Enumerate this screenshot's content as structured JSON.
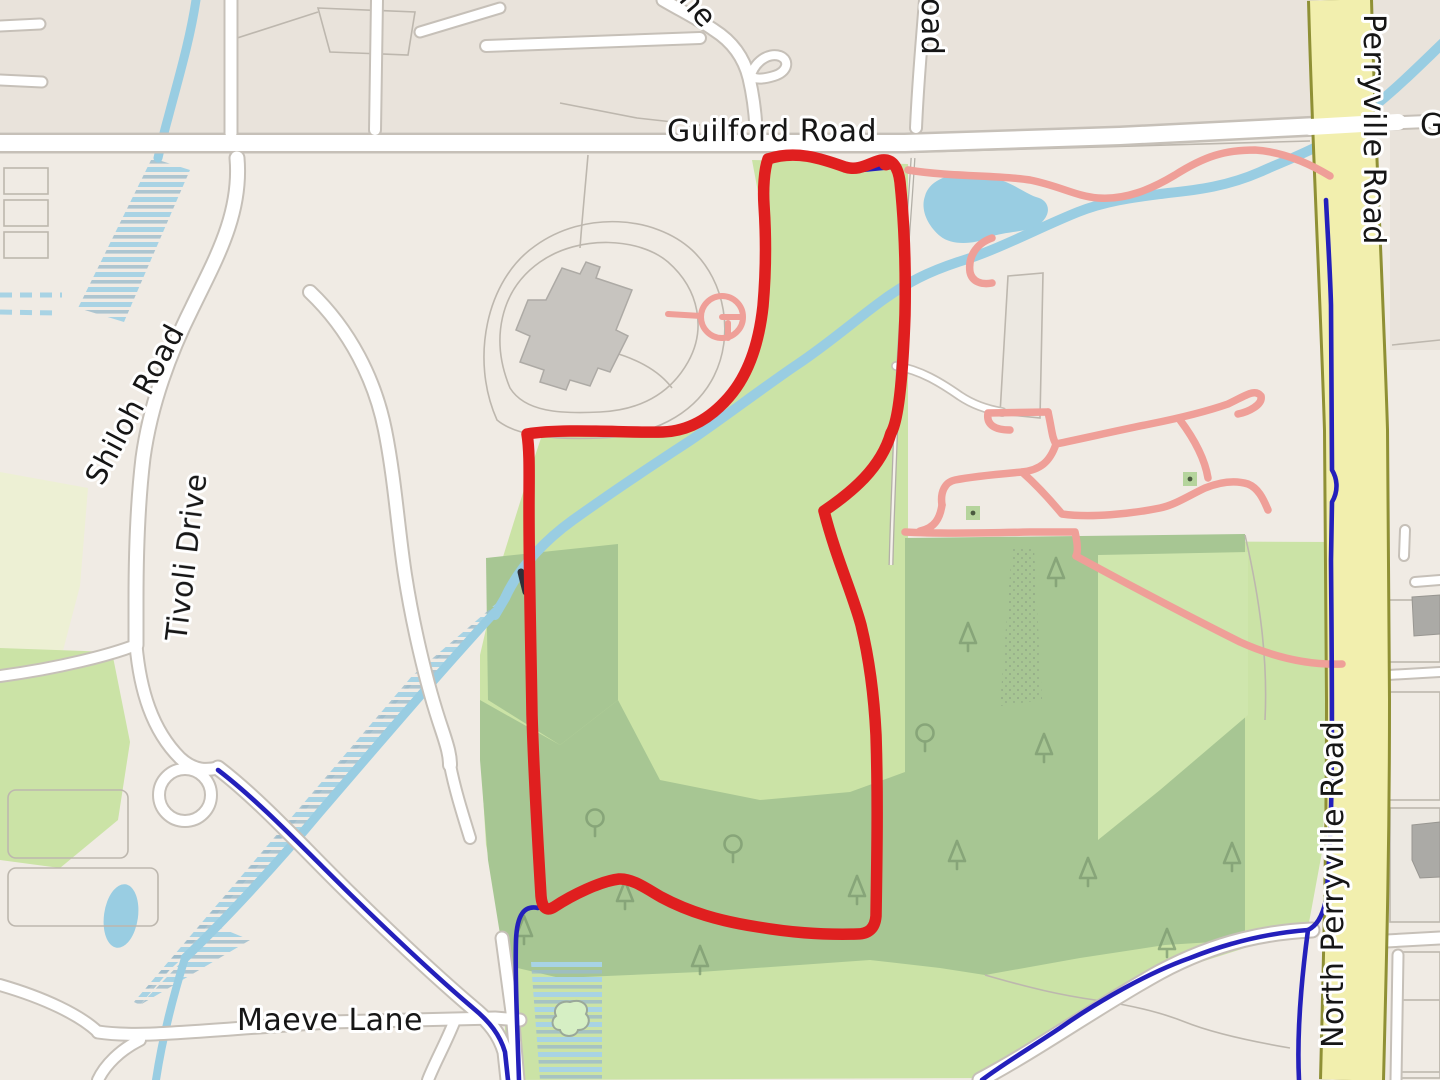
{
  "labels": {
    "guilford_road": "Guilford Road",
    "guilford_partial": "G",
    "perryville_road": "Perryville Road",
    "north_perryville_road": "North Perryville Road",
    "shiloh_road": "Shiloh Road",
    "tivoli_drive": "Tivoli Drive",
    "maeve_lane": "Maeve Lane",
    "lane_partial": "ne",
    "road_partial": "oad"
  },
  "route": {
    "color": "#e01f1f"
  },
  "colors": {
    "base": "#f0ebe4",
    "block": "#e9e3db",
    "lot": "#ece8e1",
    "outline": "#bdb7ae",
    "grass": "#cbe3a6",
    "clearing": "#cfe6ad",
    "forest": "#a7c693",
    "pale_meadow": "#edf0d4",
    "water": "#99cde2",
    "wetland_stripe": "#a8d3e4",
    "wetland_stripe2": "#9cbccb",
    "road_fill": "#ffffff",
    "road_casing": "#c6c0b8",
    "secondary_fill": "#f2efae",
    "secondary_casing": "#8f9035",
    "building": "#c7c4bf",
    "building_dark": "#abaaa6",
    "trail": "#ef9f98",
    "blue_line": "#2420bb",
    "tree": "#7d9a70",
    "tree_square": "#b5d49c",
    "label": "#161616",
    "halo": "#ffffff"
  }
}
